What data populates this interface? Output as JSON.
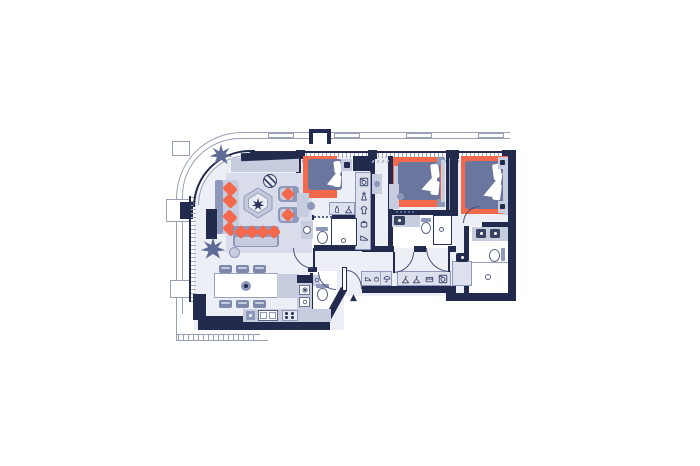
{
  "plan": {
    "type": "apartment-floor-plan",
    "entrance": {
      "marker": "▲"
    },
    "colors": {
      "wall": "#222b4e",
      "floor": "#edeff6",
      "bath_floor": "#ffffff",
      "accent_rug": "#f4684b",
      "living_rug": "#d9ddeb",
      "furniture_light": "#c7cddf",
      "furniture_mid": "#8e98bb",
      "upholstery": "#6b769f",
      "facade_line": "#9aa0b6",
      "icon_stroke": "#3a4468"
    },
    "rooms": [
      {
        "name": "living-dining-kitchen",
        "furniture": [
          "tv-console",
          "tv",
          "sofa",
          "side-console",
          "coffee-table",
          "tray-table",
          "armchair",
          "armchair",
          "small-sofa",
          "round-table",
          "plant",
          "plant",
          "dining-table",
          "dining-chairs-x6",
          "kitchen-island",
          "kitchen-counter",
          "appliance",
          "double-sink",
          "hob",
          "fridge-tower"
        ]
      },
      {
        "name": "bedroom-1",
        "furniture": [
          "double-bed",
          "nightstand",
          "wardrobe",
          "closet-column",
          "desk",
          "valet-bench"
        ]
      },
      {
        "name": "bathroom-1",
        "furniture": [
          "washbasin-cabinet",
          "toilet",
          "shower"
        ]
      },
      {
        "name": "bedroom-2",
        "furniture": [
          "double-bed",
          "bench",
          "nightstand",
          "nightstand",
          "headboard",
          "wardrobe",
          "desk"
        ]
      },
      {
        "name": "bathroom-2",
        "furniture": [
          "vanity-sink",
          "toilet",
          "shower"
        ]
      },
      {
        "name": "master-bedroom",
        "furniture": [
          "double-bed",
          "headboard-panel",
          "nightstand",
          "nightstand"
        ]
      },
      {
        "name": "master-bathroom",
        "furniture": [
          "double-vanity",
          "toilet",
          "walk-in-shower"
        ]
      },
      {
        "name": "hallway",
        "furniture": [
          "shoe-cabinet",
          "wardrobe-cabinet",
          "console-dresser",
          "pot"
        ]
      },
      {
        "name": "wc",
        "furniture": [
          "toilet",
          "corner-sink"
        ]
      }
    ],
    "closet_icons": [
      "washing-machine",
      "dress",
      "shirt",
      "bag",
      "shoes"
    ],
    "entry_cabinet_icons": [
      "shoes",
      "bag",
      "umbrella"
    ],
    "hall_cabinet_icons": [
      "hanger",
      "hanger",
      "storage-box",
      "washing-machine"
    ],
    "valet_icons": [
      "bottle",
      "hanger"
    ],
    "fridge_icons": [
      "snowflake",
      "oven"
    ],
    "dining_chair_count": 6
  }
}
